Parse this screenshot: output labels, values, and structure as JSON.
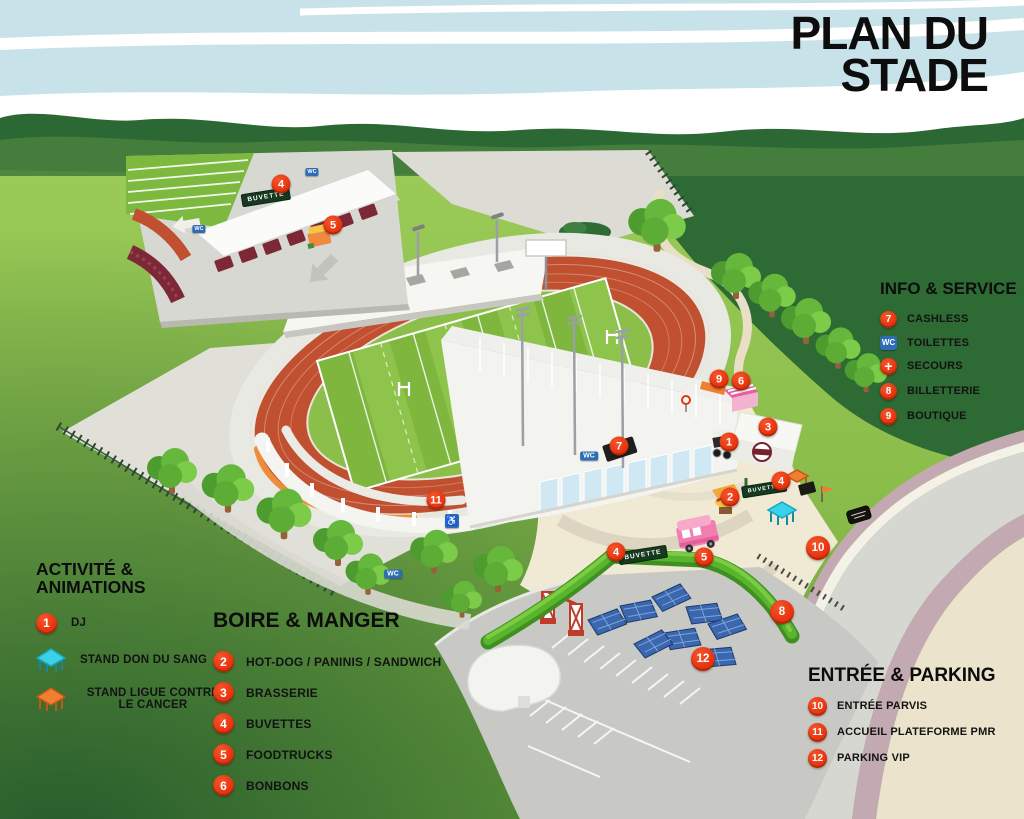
{
  "title": {
    "line1": "PLAN DU",
    "line2": "STADE"
  },
  "legends": {
    "activities": {
      "heading": "ACTIVITÉ & ANIMATIONS",
      "items": [
        {
          "badge": "1",
          "label": "DJ"
        },
        {
          "icon": "tent-cyan",
          "label": "STAND DON DU SANG"
        },
        {
          "icon": "tent-orange",
          "label": "STAND LIGUE CONTRE LE CANCER"
        }
      ]
    },
    "food": {
      "heading": "BOIRE & MANGER",
      "items": [
        {
          "badge": "2",
          "label": "HOT-DOG / PANINIS / SANDWICH"
        },
        {
          "badge": "3",
          "label": "BRASSERIE"
        },
        {
          "badge": "4",
          "label": "BUVETTES"
        },
        {
          "badge": "5",
          "label": "FOODTRUCKS"
        },
        {
          "badge": "6",
          "label": "BONBONS"
        }
      ]
    },
    "info": {
      "heading": "INFO & SERVICE",
      "items": [
        {
          "badge": "7",
          "label": "CASHLESS"
        },
        {
          "badge": "WC",
          "label": "TOILETTES"
        },
        {
          "badge": "+",
          "label": "SECOURS"
        },
        {
          "badge": "8",
          "label": "BILLETTERIE"
        },
        {
          "badge": "9",
          "label": "BOUTIQUE"
        }
      ]
    },
    "entrance": {
      "heading": "ENTRÉE & PARKING",
      "items": [
        {
          "badge": "10",
          "label": "ENTRÉE PARVIS"
        },
        {
          "badge": "11",
          "label": "ACCUEIL PLATEFORME PMR"
        },
        {
          "badge": "12",
          "label": "PARKING VIP"
        }
      ]
    }
  },
  "map": {
    "marker_labels": {
      "m1": "1",
      "m2": "2",
      "m3": "3",
      "m4": "4",
      "m5": "5",
      "m6": "6",
      "m7": "7",
      "m8": "8",
      "m9": "9",
      "m10": "10",
      "m11": "11",
      "m12": "12"
    },
    "signs": {
      "buvette": "BUVETTE",
      "wc": "WC"
    },
    "icons": {
      "accessible": "♿"
    }
  },
  "colors": {
    "marker_red": "#e6330e",
    "wc_blue": "#2e6cb5",
    "sign_green": "#16391f",
    "tent_cyan": "#39d2e8",
    "tent_orange": "#f08030",
    "title_black": "#0d0d0d"
  }
}
